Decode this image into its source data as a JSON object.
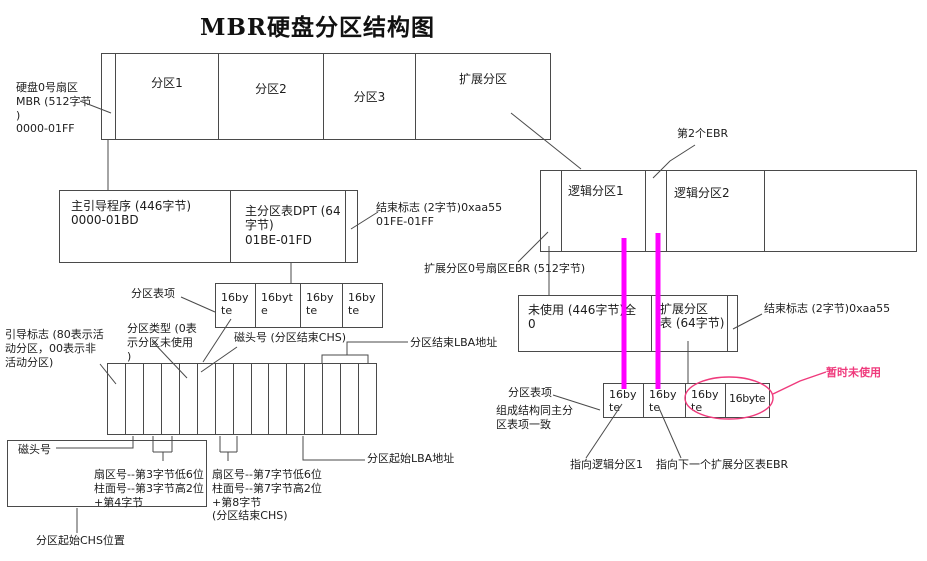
{
  "title": "MBR硬盘分区结构图",
  "colors": {
    "line": "#4a4a4a",
    "magenta": "#ff00ff",
    "pink": "#ef3a7c"
  },
  "disk_row": {
    "mbr_label": "硬盘0号扇区\nMBR (512字节\n)\n0000-01FF",
    "p1": "分区1",
    "p2": "分区2",
    "p3": "分区3",
    "ext": "扩展分区"
  },
  "mbr": {
    "boot": "主引导程序 (446字节)\n0000-01BD",
    "dpt": "主分区表DPT (64\n字节)\n01BE-01FD",
    "end_flag": "结束标志 (2字节)0xaa55\n01FE-01FF",
    "entry_label": "分区表项",
    "entries": [
      "16byte",
      "16byte",
      "16byte",
      "16byte"
    ]
  },
  "entry_detail": {
    "boot_flag": "引导标志 (80表示活\n动分区，00表示非\n活动分区)",
    "part_type": "分区类型 (0表\n示分区未使用\n)",
    "head_end": "磁头号 (分区结束CHS)",
    "end_lba": "分区结束LBA地址",
    "head": "磁头号",
    "start_chs_bytes": "扇区号--第3字节低6位\n柱面号--第3字节高2位\n+第4字节",
    "end_chs_bytes": "扇区号--第7字节低6位\n柱面号--第7字节高2位\n+第8字节\n(分区结束CHS)",
    "start_lba": "分区起始LBA地址",
    "start_chs": "分区起始CHS位置"
  },
  "ebr": {
    "sector_label": "扩展分区0号扇区EBR (512字节)",
    "second_ebr": "第2个EBR",
    "logical1": "逻辑分区1",
    "logical2": "逻辑分区2",
    "unused": "未使用 (446字节)全\n0",
    "ext_table": "扩展分区\n表 (64字节)",
    "end_flag": "结束标志 (2字节)0xaa55",
    "entry_label": "分区表项",
    "same_structure": "组成结构同主分\n区表项一致",
    "entries": [
      "16byte",
      "16byte",
      "16byte",
      "16byte"
    ],
    "point_logical1": "指向逻辑分区1",
    "point_next_ebr": "指向下一个扩展分区表EBR",
    "temp_unused": "暂时未使用"
  }
}
